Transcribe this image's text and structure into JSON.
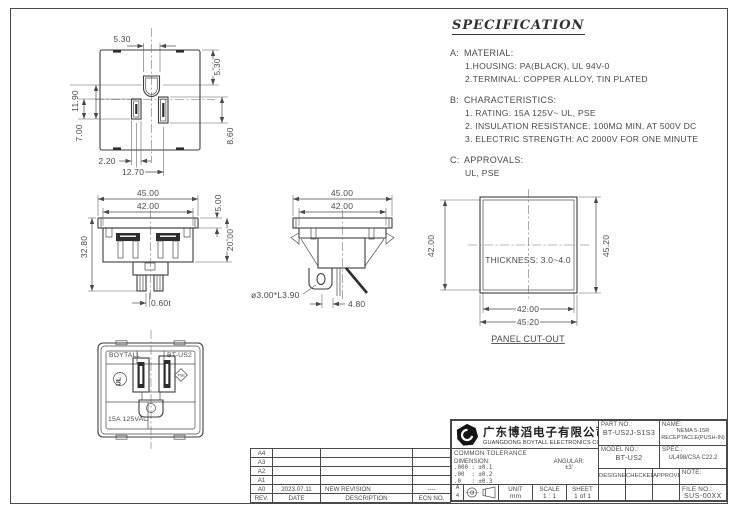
{
  "sheet": {
    "line_color": "#4a4a4a",
    "background": "#ffffff"
  },
  "specification": {
    "title": "SPECIFICATION",
    "sections": [
      {
        "label": "A:",
        "heading": "MATERIAL:",
        "lines": [
          "1.HOUSING: PA(BLACK), UL 94V-0",
          "2.TERMINAL: COPPER ALLOY, TIN PLATED"
        ]
      },
      {
        "label": "B:",
        "heading": "CHARACTERISTICS:",
        "lines": [
          "1. RATING: 15A 125V~ UL, PSE",
          "2. INSULATION RESISTANCE: 100MΩ MIN, AT 500V DC",
          "3. ELECTRIC STRENGTH: AC 2000V FOR ONE MINUTE"
        ]
      },
      {
        "label": "C:",
        "heading": "APPROVALS:",
        "lines": [
          "UL, PSE"
        ]
      }
    ]
  },
  "views": {
    "pin_view": {
      "dim_pin_width": "5.30",
      "dim_pin_offset": "5.30",
      "dim_pin_to_slot": "11.90",
      "dim_neutral_slot": "7.00",
      "dim_hot_slot": "8.60",
      "dim_slot_width": "2.20",
      "dim_slot_pitch": "12.70"
    },
    "rear_view": {
      "dim_flange_width": "45.00",
      "dim_body_width": "42.00",
      "dim_flange_height": "5.00",
      "dim_body_depth": "20.00",
      "dim_total_height": "32.80",
      "dim_terminal_thk": "0.60t"
    },
    "side_view": {
      "dim_flange_width": "45.00",
      "dim_body_width": "42.00",
      "dim_hole": "ø3.00*L3.90",
      "dim_pitch": "4.80"
    },
    "panel_cutout": {
      "title": "PANEL CUT-OUT",
      "thickness_note": "THICKNESS: 3.0~4.0",
      "dim_inner_h": "42.00",
      "dim_outer_h": "45.20",
      "dim_inner_w": "42.00",
      "dim_outer_w": "45.20"
    },
    "front_view": {
      "brand": "BOYTALL",
      "model": "BT-US2",
      "rating": "15A 125VAC",
      "ul_mark": "UL",
      "pse_mark": "PSE"
    }
  },
  "revision_table": {
    "headers": [
      "REV.",
      "DATE",
      "DESCRIPTION",
      "ECN NO."
    ],
    "rows": [
      {
        "rev": "A4",
        "date": "",
        "description": "",
        "ecn": ""
      },
      {
        "rev": "A3",
        "date": "",
        "description": "",
        "ecn": ""
      },
      {
        "rev": "A2",
        "date": "",
        "description": "",
        "ecn": ""
      },
      {
        "rev": "A1",
        "date": "",
        "description": "",
        "ecn": ""
      },
      {
        "rev": "A0",
        "date": "2023.07.11",
        "description": "NEW REVISION",
        "ecn": "----"
      }
    ]
  },
  "title_block": {
    "company_cn": "广东博滔电子有限公司",
    "company_en": "GUANGDONG BOYTALL ELECTRONICS CO.,LTD",
    "part_no_label": "PART NO.:",
    "part_no": "BT-US2J-S1S3",
    "name_label": "NAME:",
    "name_line1": "NEMA 5-15R",
    "name_line2": "RECEPTACLE(PUSH-IN)",
    "model_no_label": "MODEL NO.:",
    "model_no": "BT-US2",
    "spec_label": "SPEC.:",
    "spec_value": "UL498/CSA C22.2",
    "tolerance_title": "COMMON TOLERANCE",
    "dimension_label": "DIMENSION:",
    "angular_label": "ANGULAR:",
    "angular_value": "±3'",
    "tol_row1": ".000 : ±0.1",
    "tol_row2": ".00  : ±0.2",
    "tol_row3": ".0   : ±0.3",
    "designer_label": "DESIGNER",
    "checked_label": "CHECKED",
    "approved_label": "APPROVED",
    "note_label": "NOTE:",
    "size_letter": "A",
    "size_number": "4",
    "unit_label": "UNIT",
    "unit_value": "mm",
    "scale_label": "SCALE",
    "scale_value": "1 : 1",
    "sheet_label": "SHEET",
    "sheet_value": "1 of 1",
    "file_no_label": "FILE NO.:",
    "file_no": "SUS-00XX"
  }
}
